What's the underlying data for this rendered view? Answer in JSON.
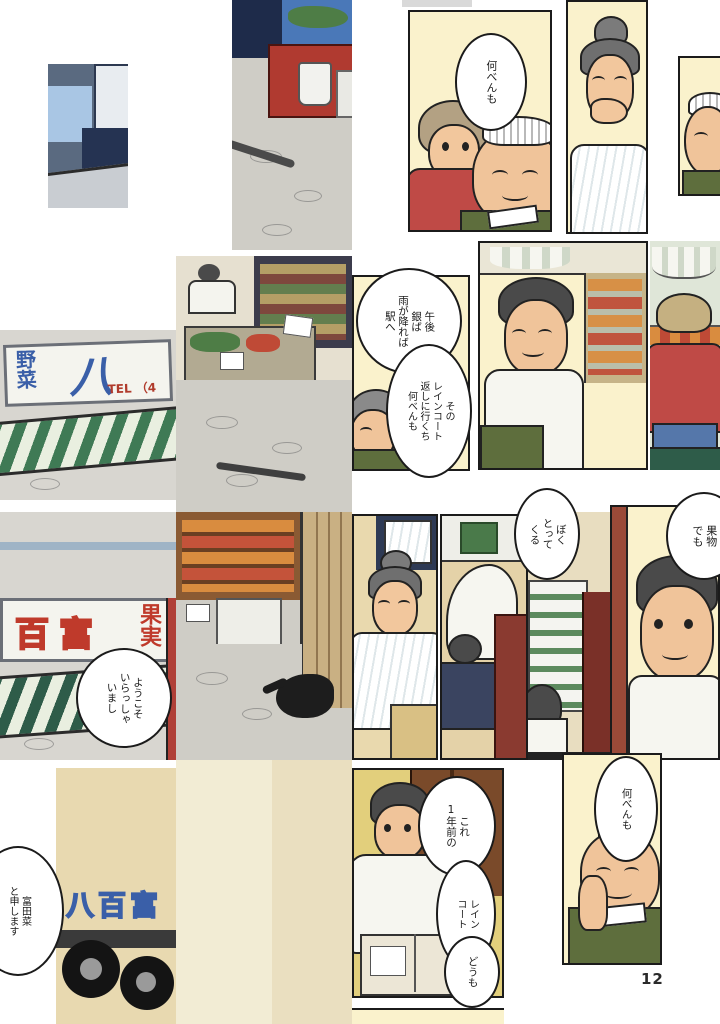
{
  "page": {
    "number": "12"
  },
  "bubbles": {
    "nanben_top": "何べんも",
    "gogo": "午後\n銀ば\n雨が降れば\n駅へ",
    "raincoat_return": "その\nレインコート\n返しに行くち\n何べんも",
    "boku": "ぼく\nとって\nくる",
    "kudamono": "果物\nでも",
    "yokoso": "ようこそ\nいらっしゃ\nいまし",
    "tomita": "富田菜\nと申します",
    "kore": "これ\n1年前の",
    "raincoat": "レイン\nコート",
    "domo": "どうも",
    "nanben_bottom": "何べんも"
  },
  "signs": {
    "yasai": "野菜",
    "hachi": "八",
    "tel": "TEL （4",
    "hyakutomi": "百富",
    "kajitsu": "果実",
    "truck_emblem": "八百富"
  },
  "colors": {
    "panel_bg": "#faf2cc",
    "shirt_red": "#bf4a46",
    "vest_green": "#5e6e3d",
    "awning_green": "#3f7a55",
    "sign_blue": "#3a5fa8",
    "sign_red": "#bf3a2b",
    "pavement": "#cfcdc6"
  }
}
